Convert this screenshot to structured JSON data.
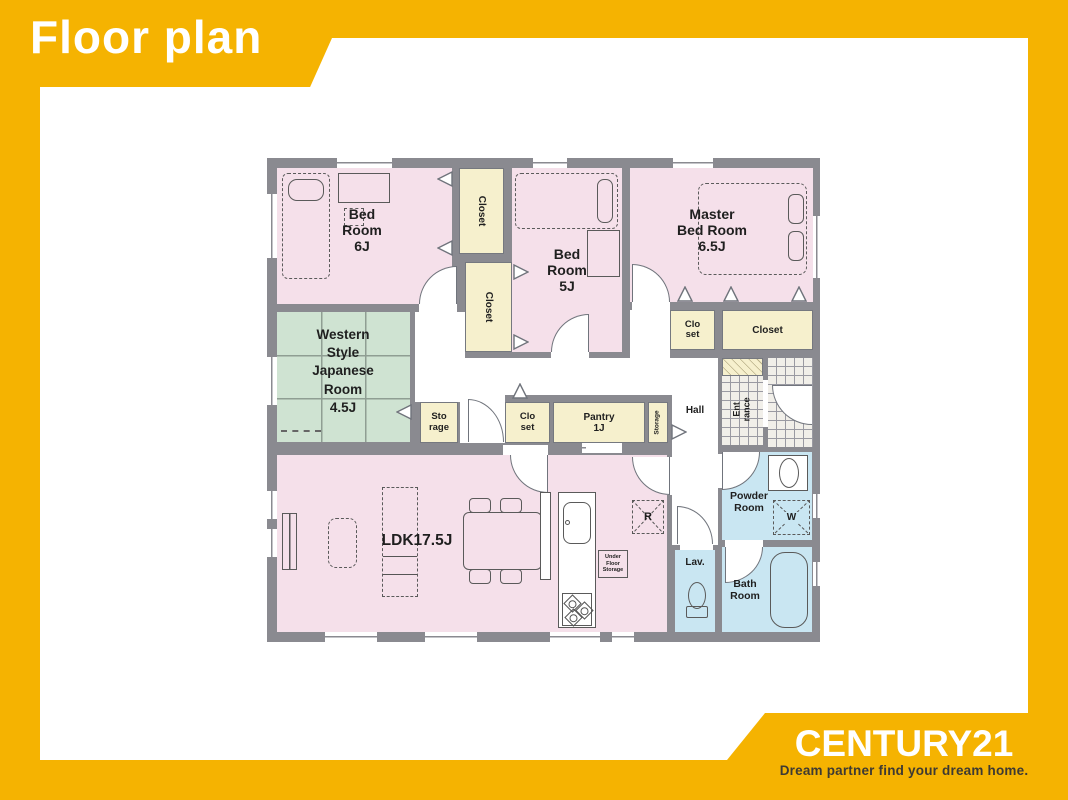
{
  "header": {
    "title": "Floor plan"
  },
  "footer": {
    "brand": "CENTURY21",
    "tagline": "Dream partner find your dream home."
  },
  "colors": {
    "brand_yellow": "#F5B301",
    "room_pink": "#F5E0EA",
    "tatami_green": "#CFE3D2",
    "closet_cream": "#F6F0CD",
    "wet_area_blue": "#C9E6F2",
    "wall_gray": "#8A8A90",
    "tagline_text": "#3E3A33"
  },
  "rooms": {
    "bedroom6": {
      "l1": "Bed",
      "l2": "Room",
      "l3": "6J"
    },
    "bedroom5": {
      "l1": "Bed",
      "l2": "Room",
      "l3": "5J"
    },
    "master": {
      "l1": "Master",
      "l2": "Bed Room",
      "l3": "6.5J"
    },
    "japanese": {
      "l1": "Western",
      "l2": "Style",
      "l3": "Japanese",
      "l4": "Room",
      "l5": "4.5J"
    },
    "ldk": {
      "label": "LDK17.5J"
    },
    "closetTop": {
      "label": "Closet"
    },
    "closetBottom": {
      "label": "Closet"
    },
    "masterClosetSmall": {
      "l1": "Clo",
      "l2": "set"
    },
    "masterCloset": {
      "label": "Closet"
    },
    "storage": {
      "l1": "Sto",
      "l2": "rage"
    },
    "hallCloset": {
      "l1": "Clo",
      "l2": "set"
    },
    "pantry": {
      "l1": "Pantry",
      "l2": "1J"
    },
    "storageSmall": {
      "label": "Storage"
    },
    "hall": {
      "label": "Hall"
    },
    "entrance": {
      "l1": "Ent",
      "l2": "rance"
    },
    "powder": {
      "l1": "Powder",
      "l2": "Room"
    },
    "bath": {
      "l1": "Bath",
      "l2": "Room"
    },
    "lav": {
      "label": "Lav."
    }
  },
  "fixtures": {
    "refrigerator": "R",
    "washer": "W",
    "ufs1": "Under",
    "ufs2": "Floor",
    "ufs3": "Storage"
  }
}
